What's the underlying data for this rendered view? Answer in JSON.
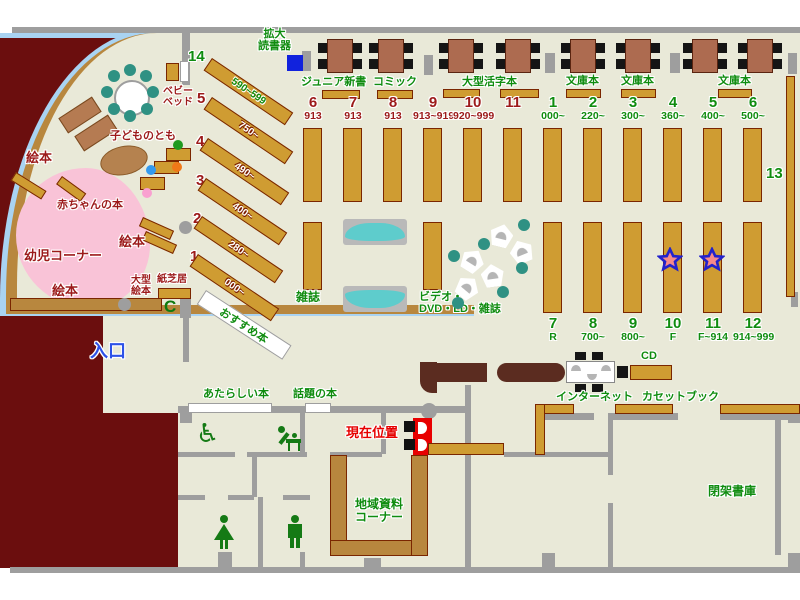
{
  "palette": {
    "floor": "#e9e9d8",
    "outside": "#6b0e0e",
    "wall_gray": "#9e9e9e",
    "glass_blue": "#a9d3f2",
    "shelf_gold": "#cf9c32",
    "wall_gold": "#b8873e",
    "table_brown": "#ad6b50",
    "counter_brown": "#5b2c20",
    "bench_teal": "#5ecccc",
    "chair_teal": "#2f9183",
    "infant_pink": "#f9c3d7",
    "text_green": "#0f8c0f",
    "text_dark_red": "#9c1a1a",
    "text_red": "#e60000",
    "text_blue": "#2d52e8",
    "magnifier_blue": "#1122dd",
    "star_fill": "#f58a8a",
    "star_stroke": "#2222cc"
  },
  "labels": {
    "kakudai_1": "拡大",
    "kakudai_2": "読書器",
    "baby_bed_1": "ベビー",
    "baby_bed_2": "ベッド",
    "kodomonotomo": "子どものとも",
    "ehon": "絵本",
    "akachan_no_hon": "赤ちゃんの本",
    "yoji_corner": "幼児コーナー",
    "ogata_1": "大型",
    "ogata_2": "絵本",
    "kamishibai": "紙芝居",
    "osusume": "おすすめ本",
    "zasshi": "雑誌",
    "video_1": "ビデオ・",
    "video_2": "DVD・LD・雑誌",
    "iriguchi": "入口",
    "atarashii": "あたらしい本",
    "wadai": "話題の本",
    "genzai": "現在位置",
    "chiiki_1": "地域資料",
    "chiiki_2": "コーナー",
    "internet": "インターネット",
    "cassette": "カセットブック",
    "cd": "CD",
    "heika": "閉架書庫",
    "thirteen": "13"
  },
  "top_labels": [
    "ジュニア新書",
    "コミック",
    "大型活字本",
    "文庫本",
    "文庫本",
    "文庫本"
  ],
  "shelf_rows": {
    "children_top": [
      {
        "num": "6",
        "sub": "913"
      },
      {
        "num": "7",
        "sub": "913"
      },
      {
        "num": "8",
        "sub": "913"
      },
      {
        "num": "9",
        "sub": "913~919"
      },
      {
        "num": "10",
        "sub": "920~999"
      },
      {
        "num": "11",
        "sub": ""
      }
    ],
    "adult_top": [
      {
        "num": "1",
        "sub": "000~"
      },
      {
        "num": "2",
        "sub": "220~"
      },
      {
        "num": "3",
        "sub": "300~"
      },
      {
        "num": "4",
        "sub": "360~"
      },
      {
        "num": "5",
        "sub": "400~"
      },
      {
        "num": "6",
        "sub": "500~"
      }
    ],
    "adult_bottom": [
      {
        "num": "7",
        "sub": "R"
      },
      {
        "num": "8",
        "sub": "700~"
      },
      {
        "num": "9",
        "sub": "800~"
      },
      {
        "num": "10",
        "sub": "F"
      },
      {
        "num": "11",
        "sub": "F~914"
      },
      {
        "num": "12",
        "sub": "914~999"
      }
    ]
  },
  "diagonal_shelves": [
    {
      "num": "14",
      "range": "590~599"
    },
    {
      "num": "5",
      "range": "750~"
    },
    {
      "num": "4",
      "range": "490~"
    },
    {
      "num": "3",
      "range": "400~"
    },
    {
      "num": "2",
      "range": "280~"
    },
    {
      "num": "1",
      "range": "000~"
    }
  ]
}
